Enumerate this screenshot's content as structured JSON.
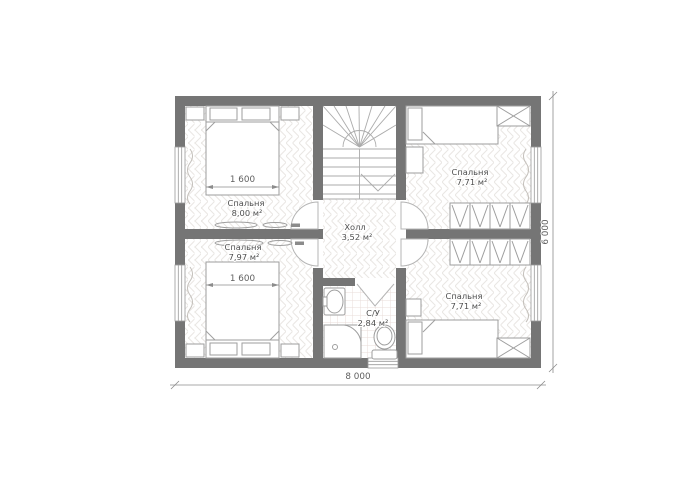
{
  "plan": {
    "rooms": [
      {
        "name": "Спальня",
        "area": "8,00 м²"
      },
      {
        "name": "Спальня",
        "area": "7,97 м²"
      },
      {
        "name": "Спальня",
        "area": "7,71 м²"
      },
      {
        "name": "Спальня",
        "area": "7,71 м²"
      },
      {
        "name": "Холл",
        "area": "3,52 м²"
      },
      {
        "name": "С/У",
        "area": "2,84 м²"
      }
    ],
    "dimensions": {
      "overall_width": "8 000",
      "overall_height": "6 000",
      "bed_width_top": "1 600",
      "bed_width_bottom": "1 600"
    },
    "colors": {
      "wall": "#757575",
      "furniture_line": "#9e9e9e",
      "door_line": "#b5b5b5",
      "text": "#4d4d4d",
      "dimension_line": "#8c8c8c",
      "parquet_line": "#e9e6e3",
      "tile_line": "#e9dcda"
    }
  }
}
